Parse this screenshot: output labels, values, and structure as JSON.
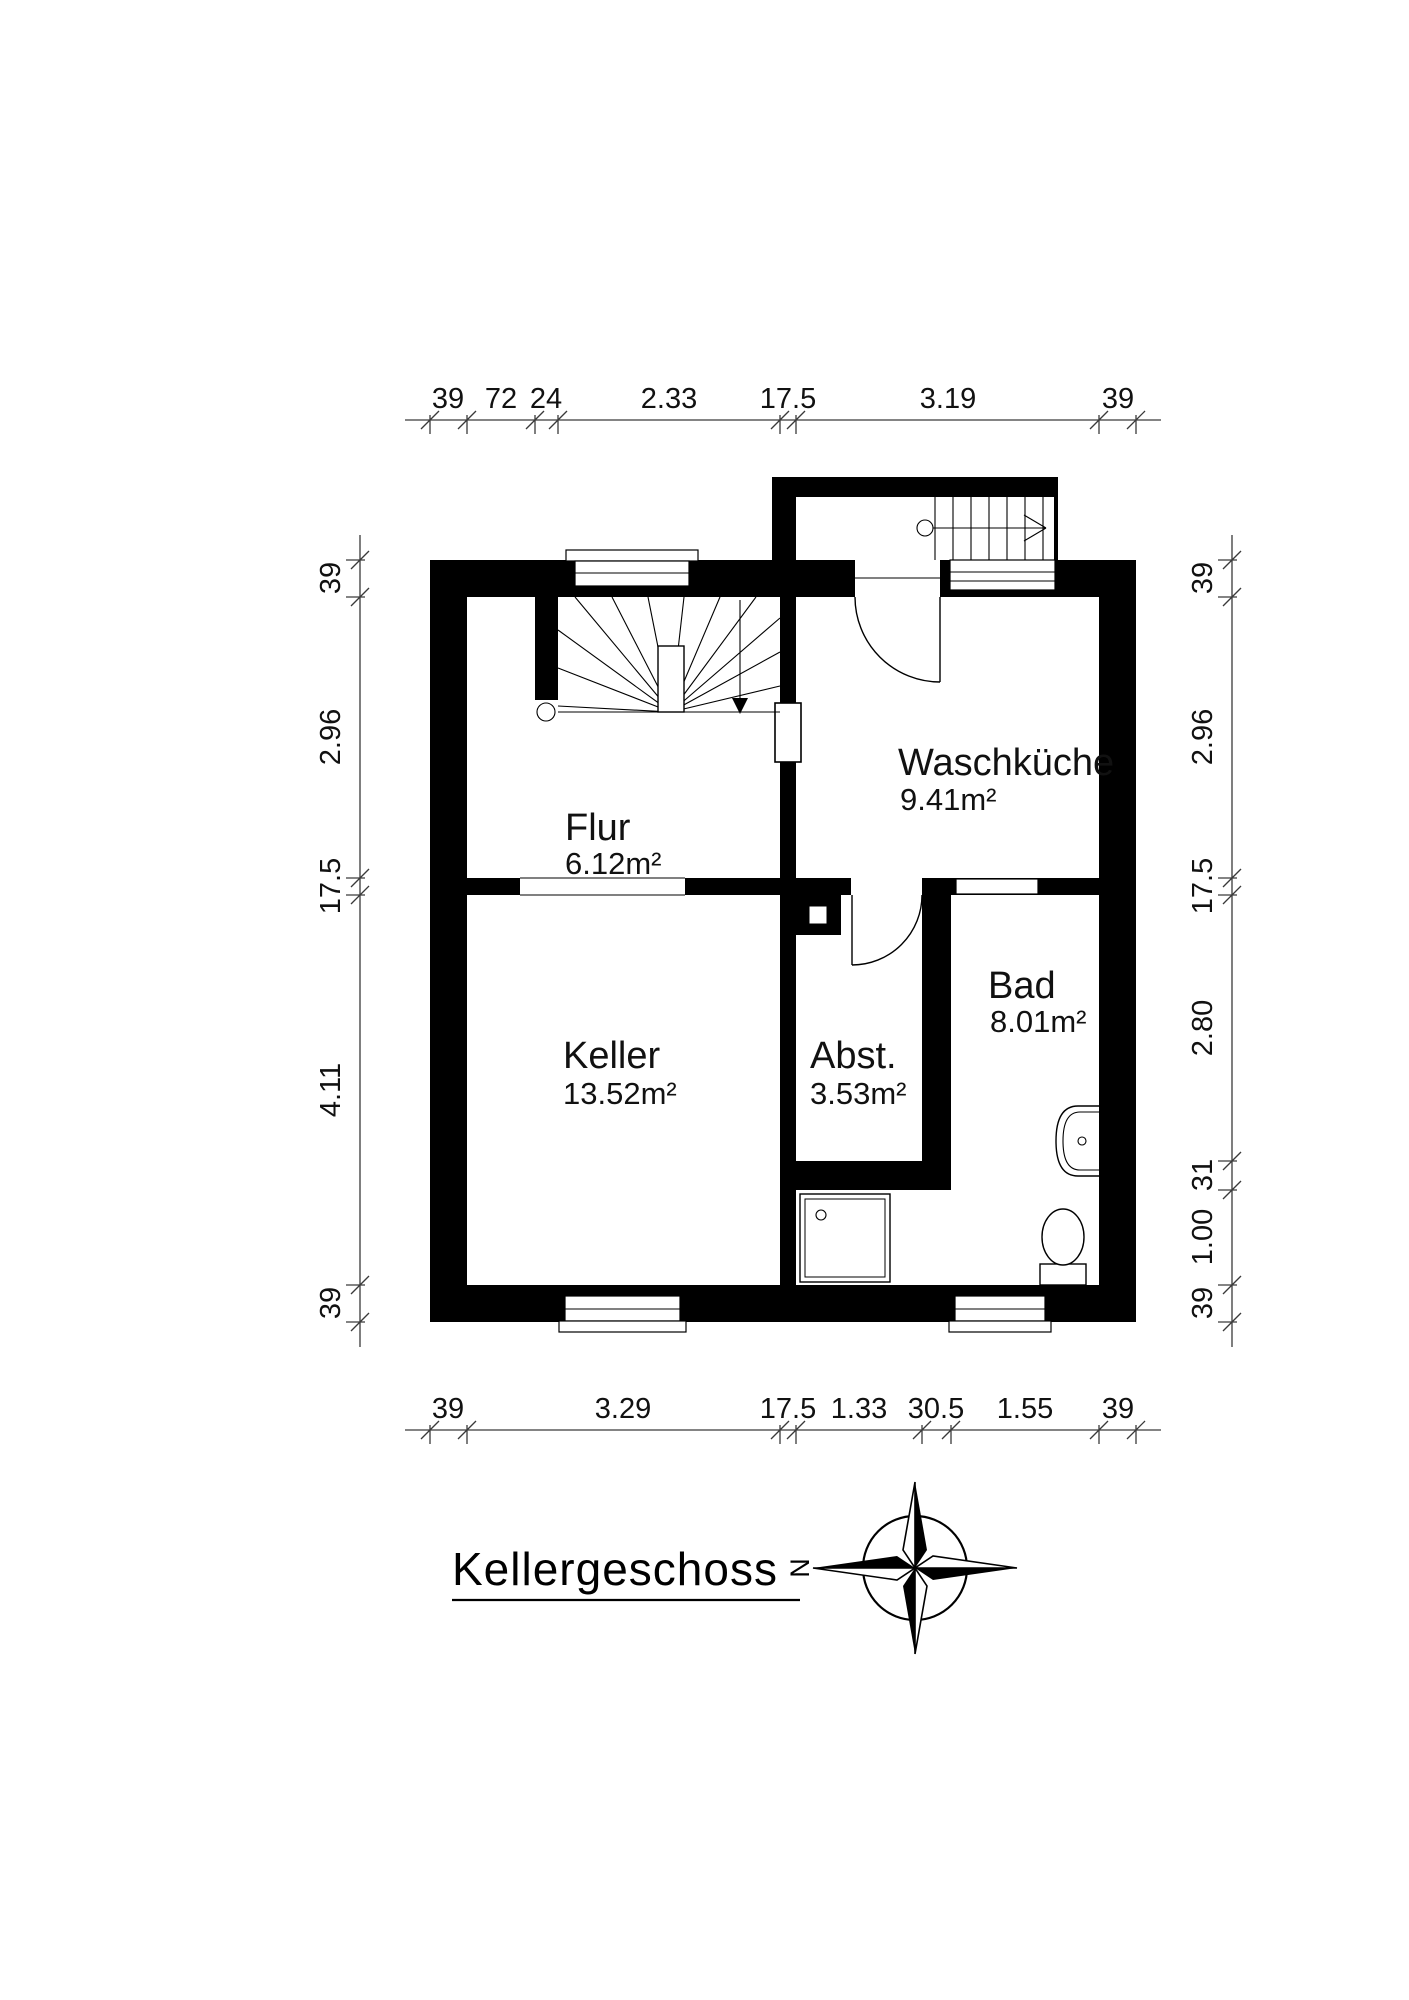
{
  "title": {
    "text": "Kellergeschoss"
  },
  "compass": {
    "letter": "N"
  },
  "rooms": [
    {
      "id": "flur",
      "name": "Flur",
      "area": "6.12m²"
    },
    {
      "id": "waschkueche",
      "name": "Waschküche",
      "area": "9.41m²"
    },
    {
      "id": "keller",
      "name": "Keller",
      "area": "13.52m²"
    },
    {
      "id": "abst",
      "name": "Abst.",
      "area": "3.53m²"
    },
    {
      "id": "bad",
      "name": "Bad",
      "area": "8.01m²"
    }
  ],
  "dimensions": {
    "top": [
      "39",
      "72",
      "24",
      "2.33",
      "17.5",
      "3.19",
      "39"
    ],
    "bottom": [
      "39",
      "3.29",
      "17.5",
      "1.33",
      "30.5",
      "1.55",
      "39"
    ],
    "left": [
      "39",
      "2.96",
      "17.5",
      "4.11",
      "39"
    ],
    "right": [
      "39",
      "2.96",
      "17.5",
      "2.80",
      "31",
      "1.00",
      "39"
    ]
  }
}
